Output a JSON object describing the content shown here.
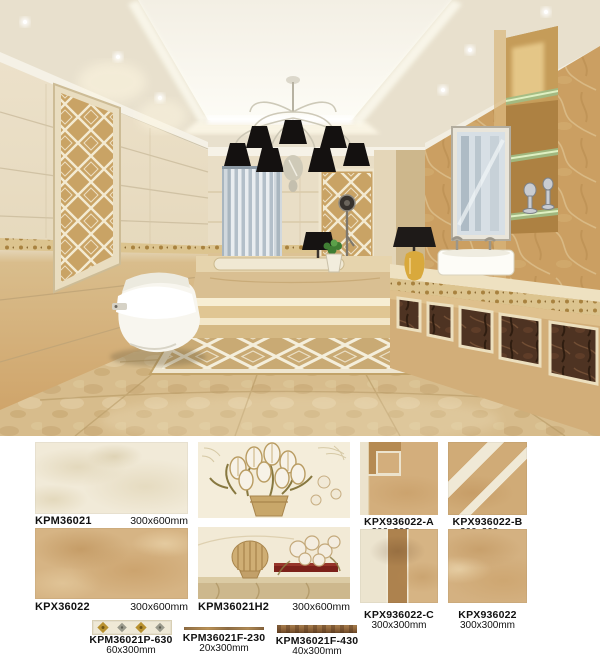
{
  "scene": {
    "kind": "bathroom-interior-render",
    "palette": {
      "ceiling": "#e6ddc9",
      "ceiling_recess": "#f8f5ec",
      "wall_cream": "#eadfc8",
      "wall_tan": "#d5b482",
      "marble_column": "#cda367",
      "dark_inset_panel": "#4e3322",
      "floor": "#d7bc8c",
      "chandelier_shade": "#141211",
      "curtain": "#c6d0d8",
      "glass_shelf": "#a8c292"
    }
  },
  "products": [
    {
      "code": "KPM36021",
      "size": "300x600mm"
    },
    {
      "code": "KPX36022",
      "size": "300x600mm"
    },
    {
      "code": "KPM36021H2",
      "size": "300x600mm"
    },
    {
      "code": "KPX936022-A",
      "size": "300x300mm"
    },
    {
      "code": "KPX936022-B",
      "size": "300x300mm"
    },
    {
      "code": "KPX936022-C",
      "size": "300x300mm"
    },
    {
      "code": "KPX936022",
      "size": "300x300mm"
    },
    {
      "code": "KPM36021P-630",
      "size": "60x300mm"
    },
    {
      "code": "KPM36021F-230",
      "size": "20x300mm"
    },
    {
      "code": "KPM36021F-430",
      "size": "40x300mm"
    }
  ]
}
